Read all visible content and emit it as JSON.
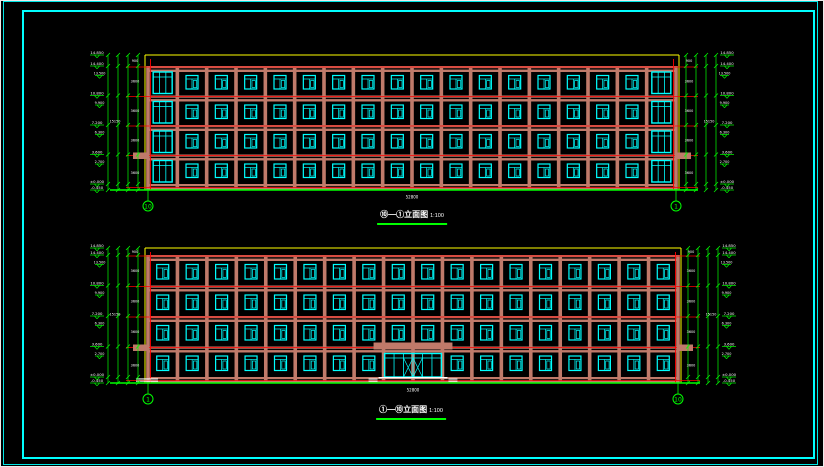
{
  "drawing": {
    "type": "architectural-elevation-sheet",
    "background": "#000000"
  },
  "palette": {
    "frame": "#00ffff",
    "wall": "#c07a6a",
    "window": "#00ffff",
    "outline": "#ffff00",
    "axis": "#ff0000",
    "dimension": "#00ff00",
    "text": "#ffffff",
    "steps": "#ffffff"
  },
  "frame": {
    "outer": [
      3,
      1,
      813,
      462
    ],
    "inner": [
      22,
      10,
      789,
      445
    ]
  },
  "shared": {
    "levels_main": [
      "14.850",
      "14.400",
      "10.800",
      "7.200",
      "3.600",
      "±0.000",
      "-0.450"
    ],
    "levels_heads": [
      "13.500",
      "9.900",
      "6.300",
      "2.700"
    ],
    "floor_dims": [
      "900",
      "3600",
      "3600",
      "3600",
      "3600"
    ],
    "total_height": "15150",
    "total_width": "52800"
  },
  "elevations": [
    {
      "name": "rear-elevation",
      "label": {
        "title": "⑩—①立面图",
        "scale": "1:100"
      },
      "axis_left": "10",
      "axis_right": "1",
      "geom": {
        "left": 148,
        "right": 676,
        "outline_top": 55,
        "wall_top": 66,
        "ground": 190,
        "floors": 4,
        "bays": 18,
        "stair_bays": [
          0,
          17
        ],
        "entrance": false,
        "end_steps": false
      }
    },
    {
      "name": "front-elevation",
      "label": {
        "title": "①—⑩立面图",
        "scale": "1:100"
      },
      "axis_left": "1",
      "axis_right": "10",
      "geom": {
        "left": 148,
        "right": 678,
        "outline_top": 248,
        "wall_top": 255,
        "ground": 383,
        "floors": 4,
        "bays": 18,
        "stair_bays": [],
        "entrance": true,
        "end_steps": true
      }
    }
  ]
}
